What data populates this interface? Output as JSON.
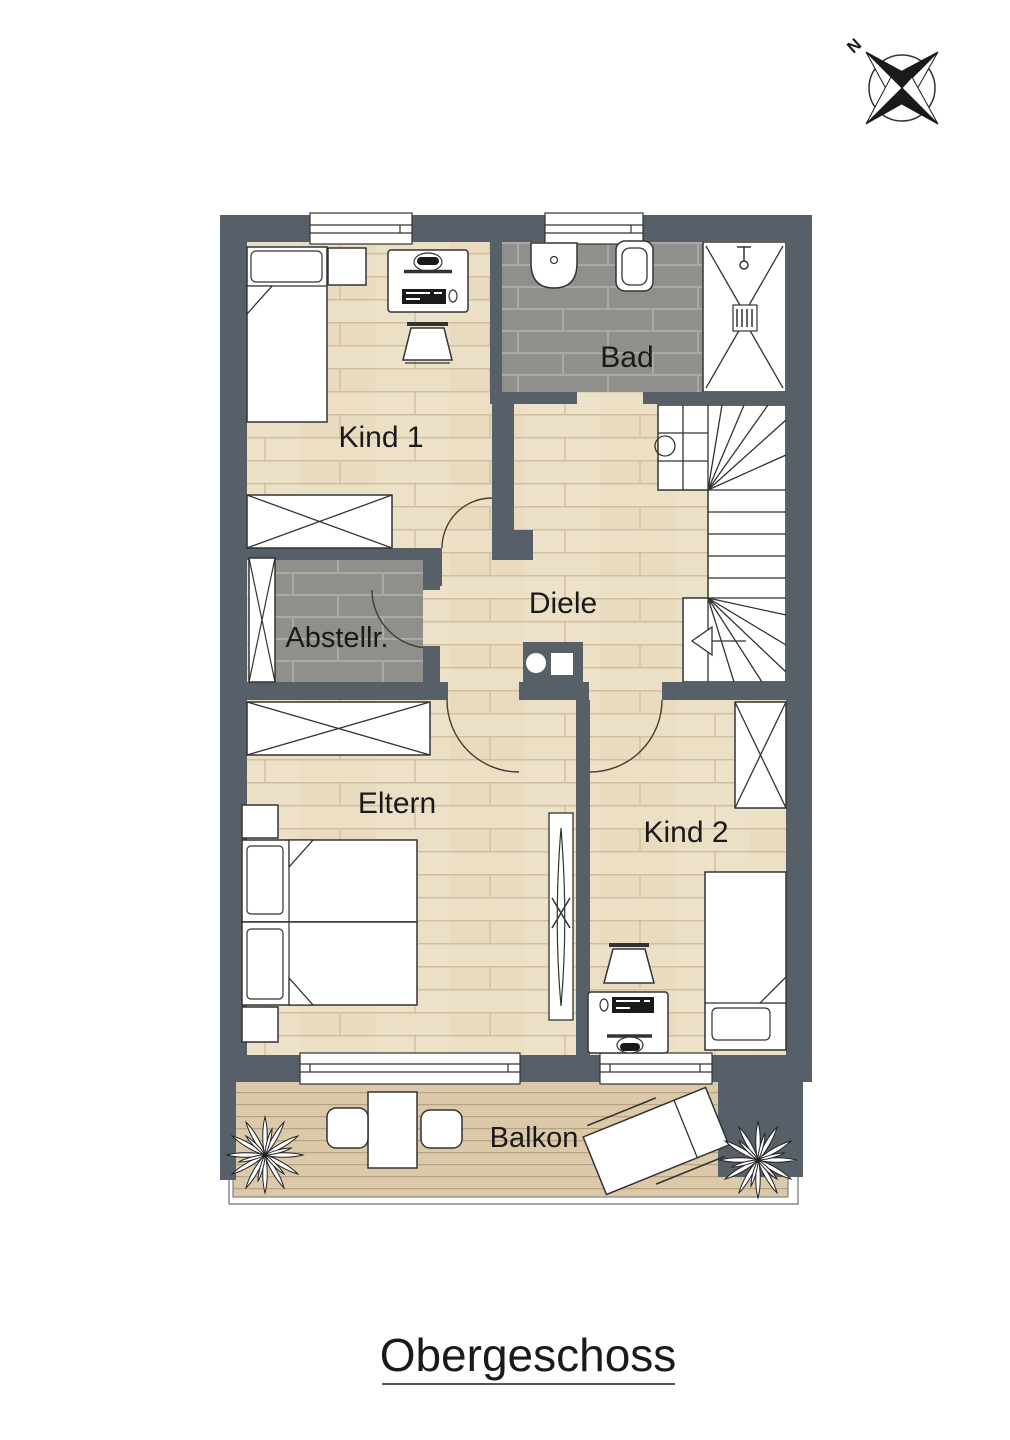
{
  "title": {
    "text": "Obergeschoss"
  },
  "compass": {
    "north_label": "N"
  },
  "rooms": [
    {
      "id": "kind1",
      "label": "Kind 1"
    },
    {
      "id": "bad",
      "label": "Bad"
    },
    {
      "id": "diele",
      "label": "Diele"
    },
    {
      "id": "abstellraum",
      "label": "Abstellr."
    },
    {
      "id": "eltern",
      "label": "Eltern"
    },
    {
      "id": "kind2",
      "label": "Kind 2"
    },
    {
      "id": "balkon",
      "label": "Balkon"
    }
  ],
  "furniture": {
    "kind1": [
      "single-bed",
      "nightstand",
      "desk",
      "monitor",
      "keyboard",
      "mouse",
      "chair",
      "wardrobe"
    ],
    "bad": [
      "washbasin",
      "toilet",
      "shower",
      "shower-head",
      "drain"
    ],
    "abstellraum": [
      "shelf-cabinet",
      "door-swing"
    ],
    "diele": [
      "staircase",
      "installation-shaft",
      "stair-direction-arrow"
    ],
    "eltern": [
      "wardrobe",
      "double-bed",
      "nightstand",
      "nightstand",
      "radiator"
    ],
    "kind2": [
      "wardrobe",
      "single-bed",
      "desk",
      "monitor",
      "keyboard",
      "mouse",
      "chair"
    ],
    "balkon": [
      "plant",
      "table",
      "chair",
      "chair",
      "sun-lounger",
      "plant"
    ]
  },
  "colors": {
    "wall": "#576069",
    "floor_wood": "#ebdfc6",
    "floor_plank_line": "#d2bf9e",
    "tile": "#8f8f8b",
    "tile_grout": "#a9a9a5",
    "deck": "#dcc9a9",
    "deck_line": "#b5a384",
    "outline": "#333333",
    "furniture_fill": "#ffffff",
    "text": "#1a1a1a"
  }
}
